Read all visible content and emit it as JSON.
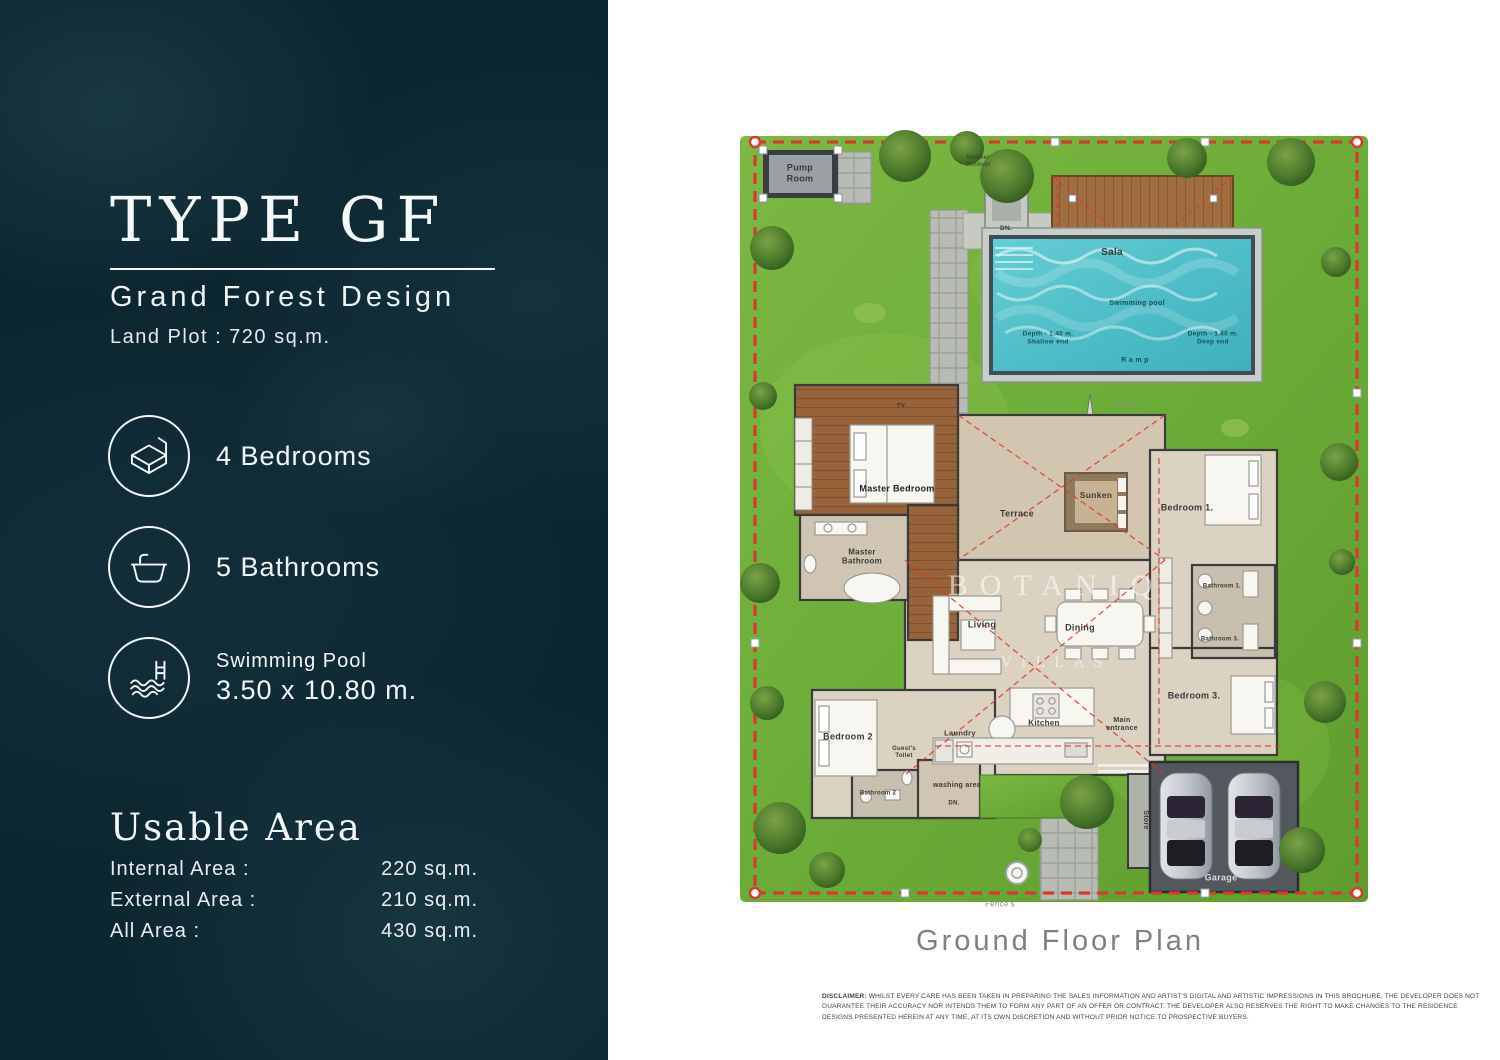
{
  "left_panel": {
    "type_title": "TYPE GF",
    "subtitle": "Grand Forest Design",
    "land_plot": "Land Plot : 720 sq.m.",
    "features": [
      {
        "icon": "bed-icon",
        "line1": "4 Bedrooms"
      },
      {
        "icon": "bathtub-icon",
        "line1": "5 Bathrooms"
      },
      {
        "icon": "pool-icon",
        "line1": "Swimming Pool",
        "line2": "3.50 x 10.80 m."
      }
    ],
    "usable_area": {
      "title": "Usable Area",
      "rows": [
        {
          "label": "Internal Area :",
          "value": "220 sq.m."
        },
        {
          "label": "External Area :",
          "value": "210 sq.m."
        },
        {
          "label": "All Area :",
          "value": "430 sq.m."
        }
      ]
    },
    "colors": {
      "background": "#0d2731",
      "text": "#f2f6f7"
    }
  },
  "plan": {
    "caption": "Ground Floor Plan",
    "watermark": {
      "line1": "BOTANIQ",
      "line2": "VILLAS"
    },
    "labels": {
      "pump_room": "Pump\nRoom",
      "shower_outdoor": "Shower\nOutdoor",
      "dn_pool": "DN.",
      "sala": "Sala",
      "swimming_pool": "Swimming pool",
      "depth_shallow": "Depth - 1.40 m.\nShallow end",
      "depth_deep": "Depth - 1.60 m.\nDeep end",
      "ramp": "R a m p",
      "garden": "Garden",
      "tv": "TV",
      "master_bedroom": "Master Bedroom",
      "master_bathroom": "Master\nBathroom",
      "terrace": "Terrace",
      "sunken": "Sunken",
      "bedroom1": "Bedroom 1.",
      "bathroom1": "Bathroom 1.",
      "bathroom3": "Bathroom 3.",
      "living": "Living",
      "dining": "Dining",
      "kitchen": "Kitchen",
      "laundry": "Laundry",
      "guests_toilet": "Guest's\nToilet",
      "bedroom2": "Bedroom 2",
      "bathroom2": "Bathroom 2",
      "washing_area": "washing area",
      "dn_washing": "DN.",
      "main_entrance": "Main\nentrance",
      "bedroom3": "Bedroom 3.",
      "store": "Store",
      "garage": "Garage",
      "fences": "Fence's"
    },
    "colors": {
      "grass": "#6fae3c",
      "pool_water": "#55c2cb",
      "boundary_red": "#d9392e",
      "wood_deck": "#a06d40",
      "floor_beige": "#d9cfbf",
      "garage_slab": "#53585e"
    }
  },
  "disclaimer": {
    "heading": "DISCLAIMER:",
    "body": " WHILST EVERY CARE HAS BEEN TAKEN IN PREPARING THE SALES INFORMATION AND ARTIST'S DIGITAL AND ARTISTIC IMPRESSIONS IN THIS BROCHURE, THE DEVELOPER DOES NOT GUARANTEE THEIR ACCURACY NOR INTENDS THEM TO FORM ANY PART OF AN OFFER OR CONTRACT. THE DEVELOPER ALSO RESERVES THE RIGHT TO MAKE CHANGES TO THE RESIDENCE DESIGNS PRESENTED HEREIN AT ANY TIME, AT ITS OWN DISCRETION AND WITHOUT PRIOR NOTICE TO PROSPECTIVE BUYERS."
  }
}
